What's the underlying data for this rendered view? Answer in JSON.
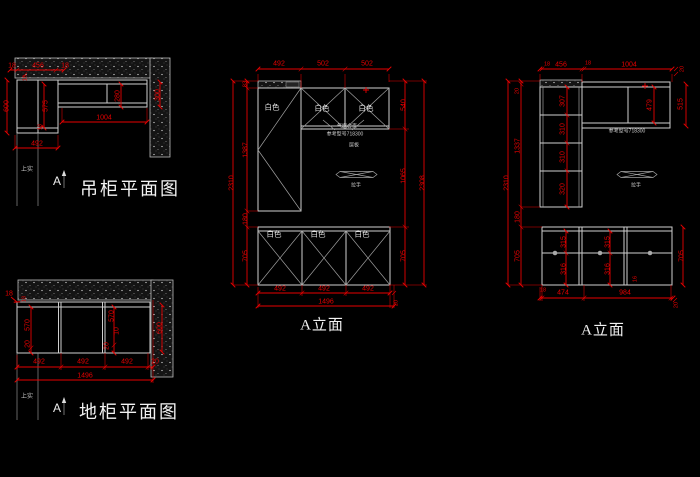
{
  "colors": {
    "background": "#000000",
    "line": "#cfcfcf",
    "dimension": "#e80000",
    "text": "#f2f2f2"
  },
  "hanging_plan": {
    "title": "吊柜平面图",
    "section_label": "A",
    "note": "上实",
    "dims": {
      "top": [
        "18",
        "456",
        "18"
      ],
      "left_600": "600",
      "inner_575": "575",
      "small_18_top": "18",
      "small_18_bottom": "18",
      "inner_280": "280",
      "width_1004": "1004",
      "right_300": "300",
      "bottom_492": "492"
    }
  },
  "base_plan": {
    "title": "地柜平面图",
    "section_label": "A",
    "note": "上实",
    "dims": {
      "wall_18": "18",
      "small_18": "18",
      "left_570": "570",
      "left_20": "20",
      "mid_570": "570",
      "mid_10": "10",
      "mid_20": "20",
      "right_600": "600",
      "bottom": [
        "492",
        "492",
        "492"
      ],
      "bottom_20": "20",
      "total": "1496"
    }
  },
  "elevation_mid": {
    "title": "A立面",
    "door_labels": {
      "tall": "白色",
      "flip_left": "白色",
      "flip_right": "白色",
      "base_1": "白色",
      "base_2": "白色",
      "base_3": "白色"
    },
    "notes": {
      "hinge": "气撑合页",
      "reference": "参考型号718300",
      "shelf": "层板",
      "handle": "拉手"
    },
    "dims": {
      "top": [
        "492",
        "502",
        "502"
      ],
      "left_chain": [
        "83",
        "1387",
        "180",
        "705"
      ],
      "left_total": "2310",
      "right_chain": [
        "540",
        "1065",
        "705"
      ],
      "right_total": "2308",
      "bottom": [
        "492",
        "492",
        "492"
      ],
      "bottom_total": "1496",
      "bottom_right_20": "20"
    }
  },
  "elevation_right": {
    "title": "A立面",
    "notes": {
      "reference": "参考型号718300",
      "handle": "拉手"
    },
    "dims": {
      "top": [
        "18",
        "456",
        "18",
        "1004"
      ],
      "top_right_20": "20",
      "right_515": "515",
      "inner_479": "479",
      "left_total": "2310",
      "left_chain": [
        "20",
        "1337",
        "180",
        "705"
      ],
      "shelves": [
        "307",
        "310",
        "310",
        "320"
      ],
      "right_705": "705",
      "drawers_left": [
        "315",
        "316"
      ],
      "drawers_mid": [
        "315",
        "316"
      ],
      "drawer_16": "16",
      "bottom": [
        "18",
        "474",
        "984"
      ],
      "bottom_20": "20"
    }
  }
}
